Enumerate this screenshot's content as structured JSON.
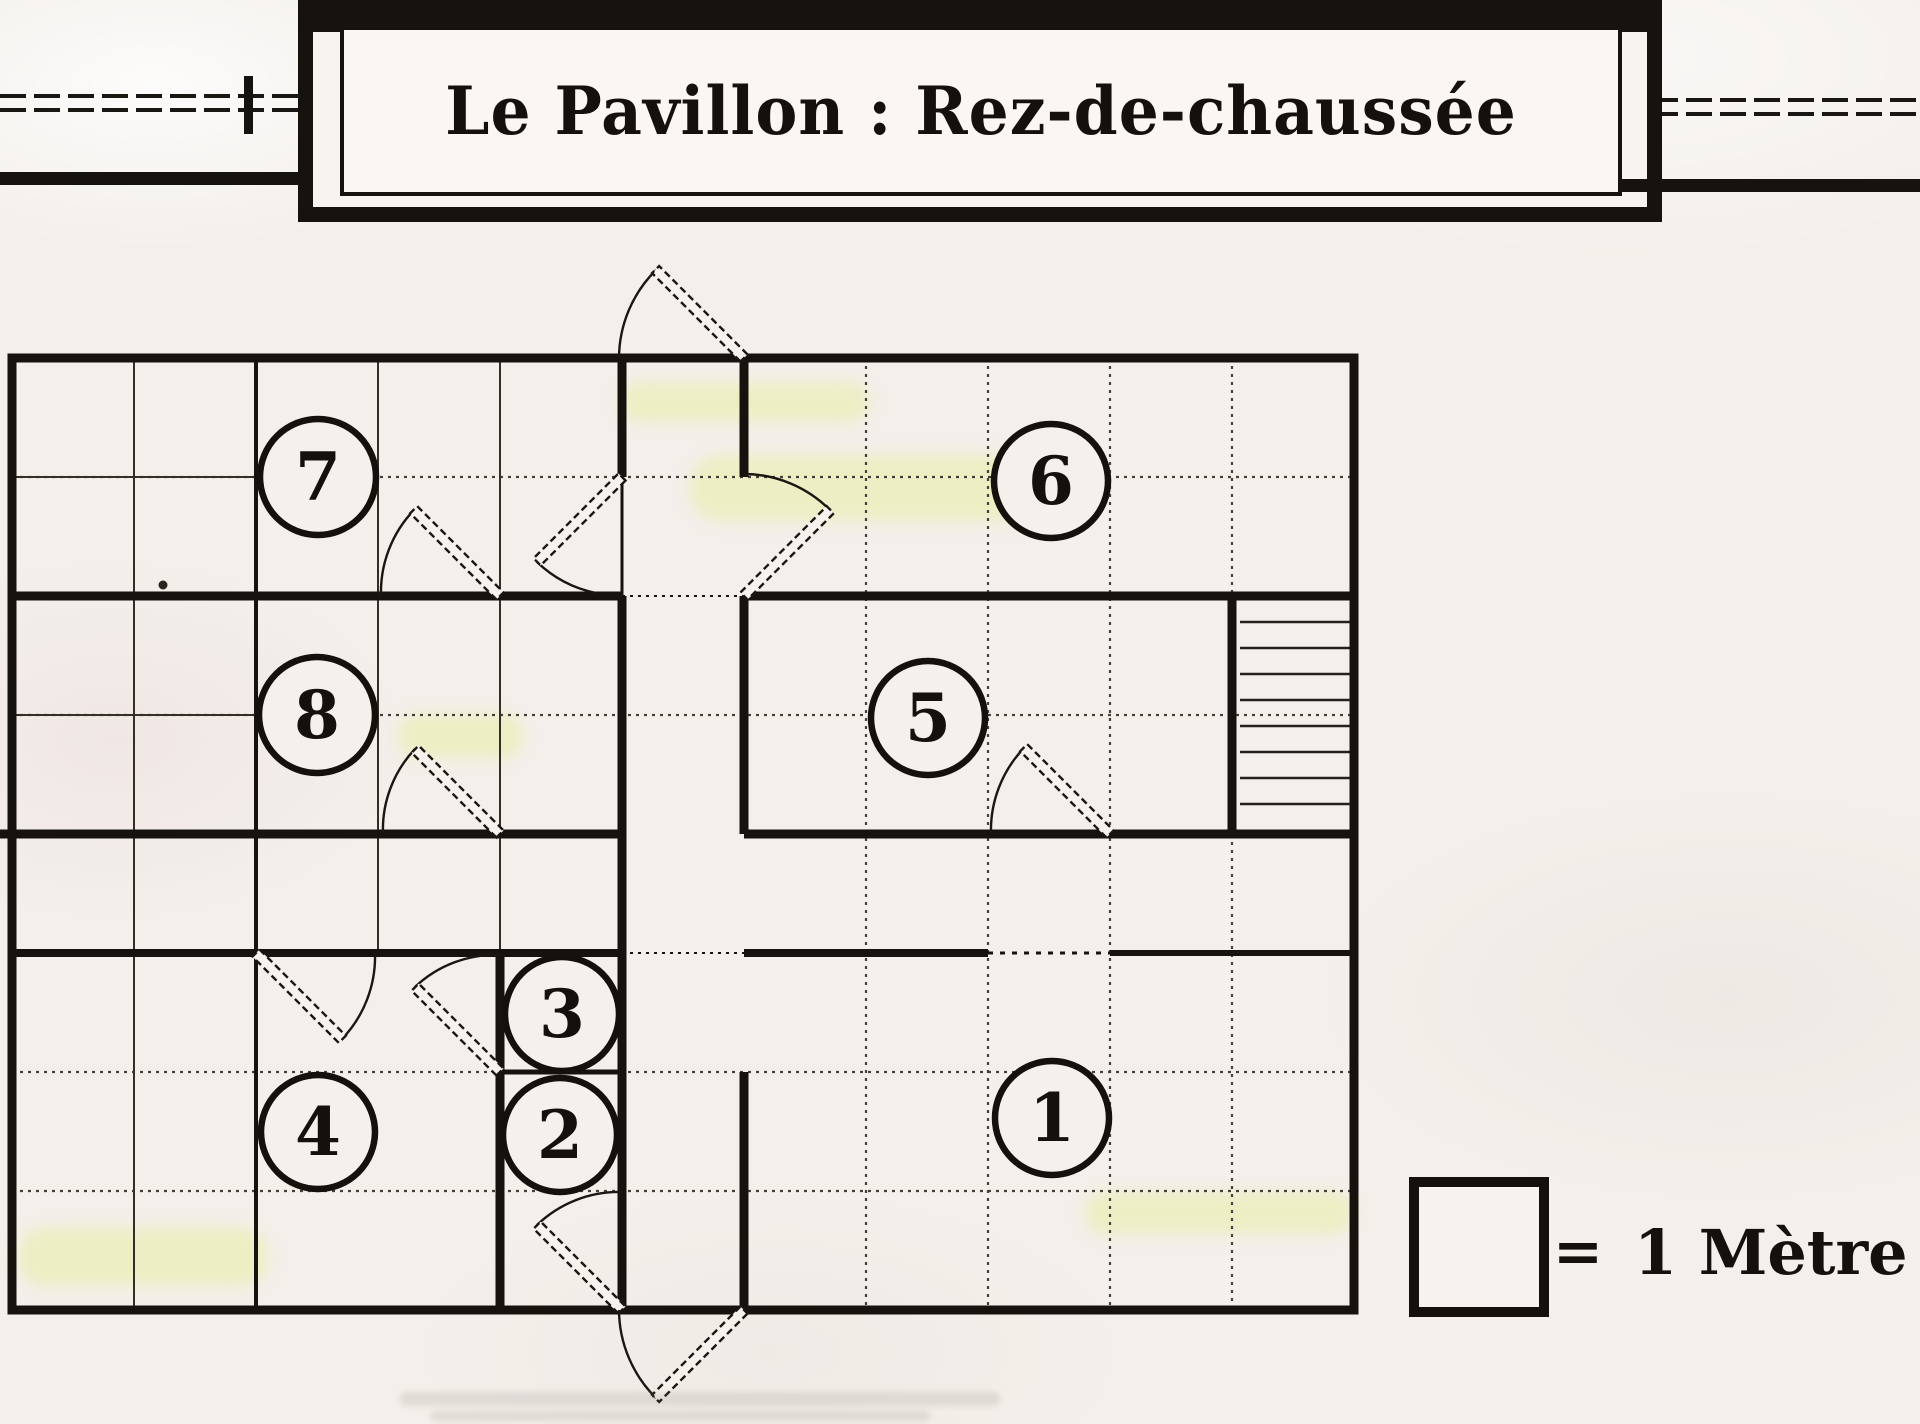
{
  "title": {
    "text": "Le Pavillon : Rez-de-chaussée"
  },
  "legend": {
    "equals_sign": "=",
    "label": "1 Mètre"
  },
  "rooms": [
    {
      "label": "1"
    },
    {
      "label": "2"
    },
    {
      "label": "3"
    },
    {
      "label": "4"
    },
    {
      "label": "5"
    },
    {
      "label": "6"
    },
    {
      "label": "7"
    },
    {
      "label": "8"
    }
  ],
  "colors": {
    "ink": "#1a1611",
    "paper": "#f3efea",
    "paper_light": "#faf7f3",
    "highlight": "#e7ee9f"
  }
}
